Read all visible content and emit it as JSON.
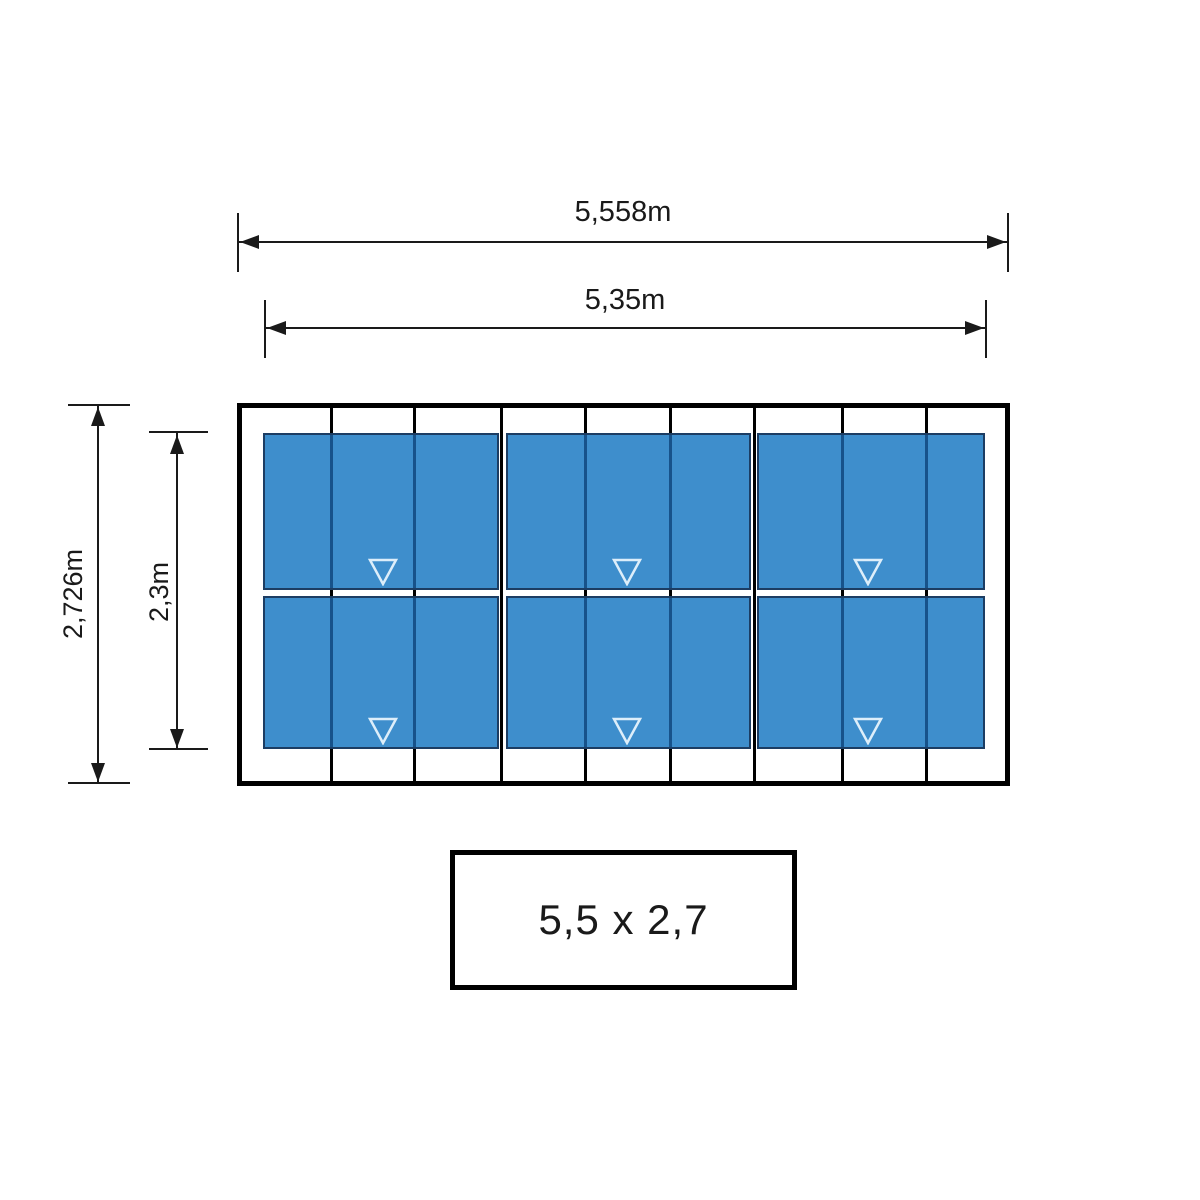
{
  "drawing": {
    "top_dimensions": [
      {
        "id": "overall-width",
        "label": "5,558m"
      },
      {
        "id": "panel-area-width",
        "label": "5,35m"
      }
    ],
    "left_dimensions": [
      {
        "id": "overall-depth",
        "label": "2,726m"
      },
      {
        "id": "panel-area-depth",
        "label": "2,3m"
      }
    ],
    "caption": "5,5 x 2,7",
    "panel_grid": {
      "columns": 3,
      "rows": 2,
      "rafter_count": 8,
      "marker": "triangle-down-icon",
      "markers_per_panel": 1
    },
    "colors": {
      "panel_fill": "#3E8ECC",
      "panel_border": "#1C3D63",
      "panel_rafter_line": "#17528A",
      "marker_stroke": "#DDEEFA",
      "dimension_line": "#1A1A1A",
      "frame_line": "#000000"
    }
  }
}
